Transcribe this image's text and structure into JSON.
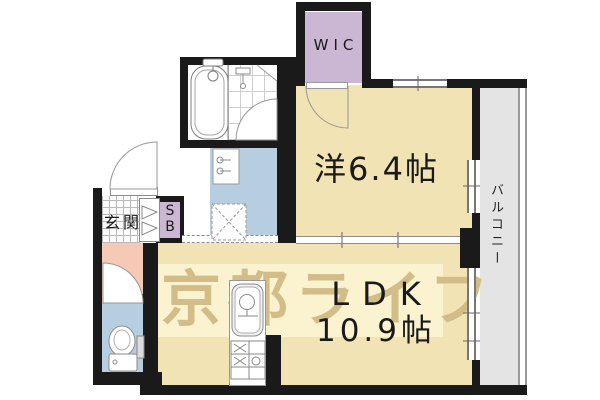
{
  "rooms": {
    "wic": {
      "label": "WIC"
    },
    "bedroom": {
      "label": "洋6.4帖"
    },
    "ldk": {
      "line1": "LDK",
      "line2": "10.9帖"
    },
    "balcony": {
      "label": "バルコニー"
    },
    "entrance": {
      "label": "玄関"
    },
    "shoe_box": {
      "label": "SB"
    }
  },
  "watermark": {
    "text": "京都ライフ"
  },
  "colors": {
    "room_beige": "#f2e3b4",
    "wic_purple": "#cbb7d3",
    "water_blue": "#b6cedf",
    "hall_pink": "#f6c9b7",
    "balcony_gray": "#e4e4e4",
    "wall_black": "#1a1a1a",
    "band_cream": "#fbf3d0",
    "watermark_tan": "#d2bd89",
    "label_black": "#1a1a1a"
  }
}
